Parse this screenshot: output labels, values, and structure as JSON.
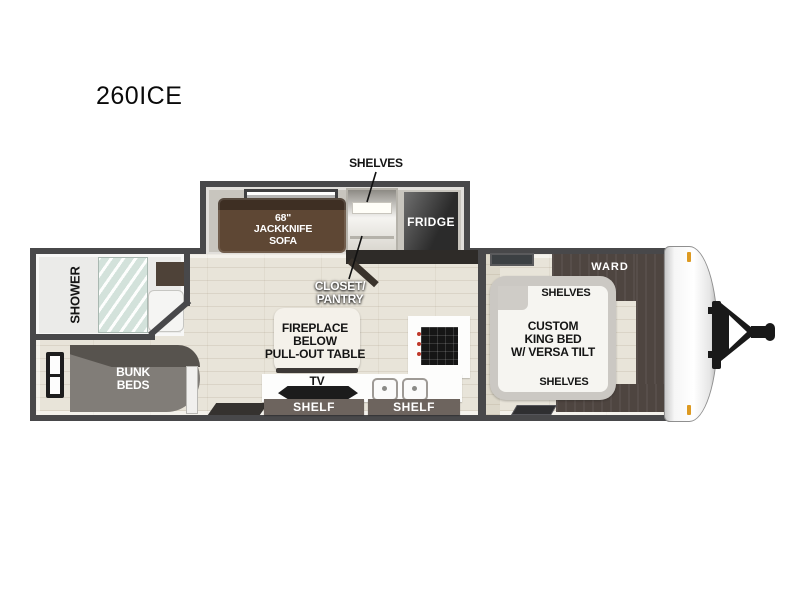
{
  "title": "260ICE",
  "plan": {
    "shelves_pointer_label": "SHELVES",
    "sofa_lines": [
      "68\"",
      "JACKKNIFE",
      "SOFA"
    ],
    "fridge_label": "FRIDGE",
    "closet_lines": [
      "CLOSET/",
      "PANTRY"
    ],
    "shower_label": "SHOWER",
    "bunk_lines": [
      "BUNK",
      "BEDS"
    ],
    "fireplace_lines": [
      "FIREPLACE",
      "BELOW",
      "PULL-OUT TABLE"
    ],
    "tv_label": "TV",
    "shelf_left_label": "SHELF",
    "shelf_right_label": "SHELF",
    "ward_label": "WARD",
    "bed_shelves_top_label": "SHELVES",
    "bed_lines": [
      "CUSTOM",
      "KING BED",
      "W/ VERSA TILT"
    ],
    "bed_shelves_bottom_label": "SHELVES"
  },
  "colors": {
    "wall": "#48484a",
    "floor": "#e8e4d9",
    "slideout_floor": "#c8c5be",
    "sofa_brown": "#5e4734",
    "fridge_dark": "#3a3a3a",
    "bunk_gray": "#817d78",
    "ward_brown": "#4e4540",
    "shower_glass": "#d3e2db",
    "shelf_bar": "#6d645e",
    "marker_amber": "#dd9a22",
    "label_dark": "#141414",
    "label_white": "#ffffff"
  }
}
